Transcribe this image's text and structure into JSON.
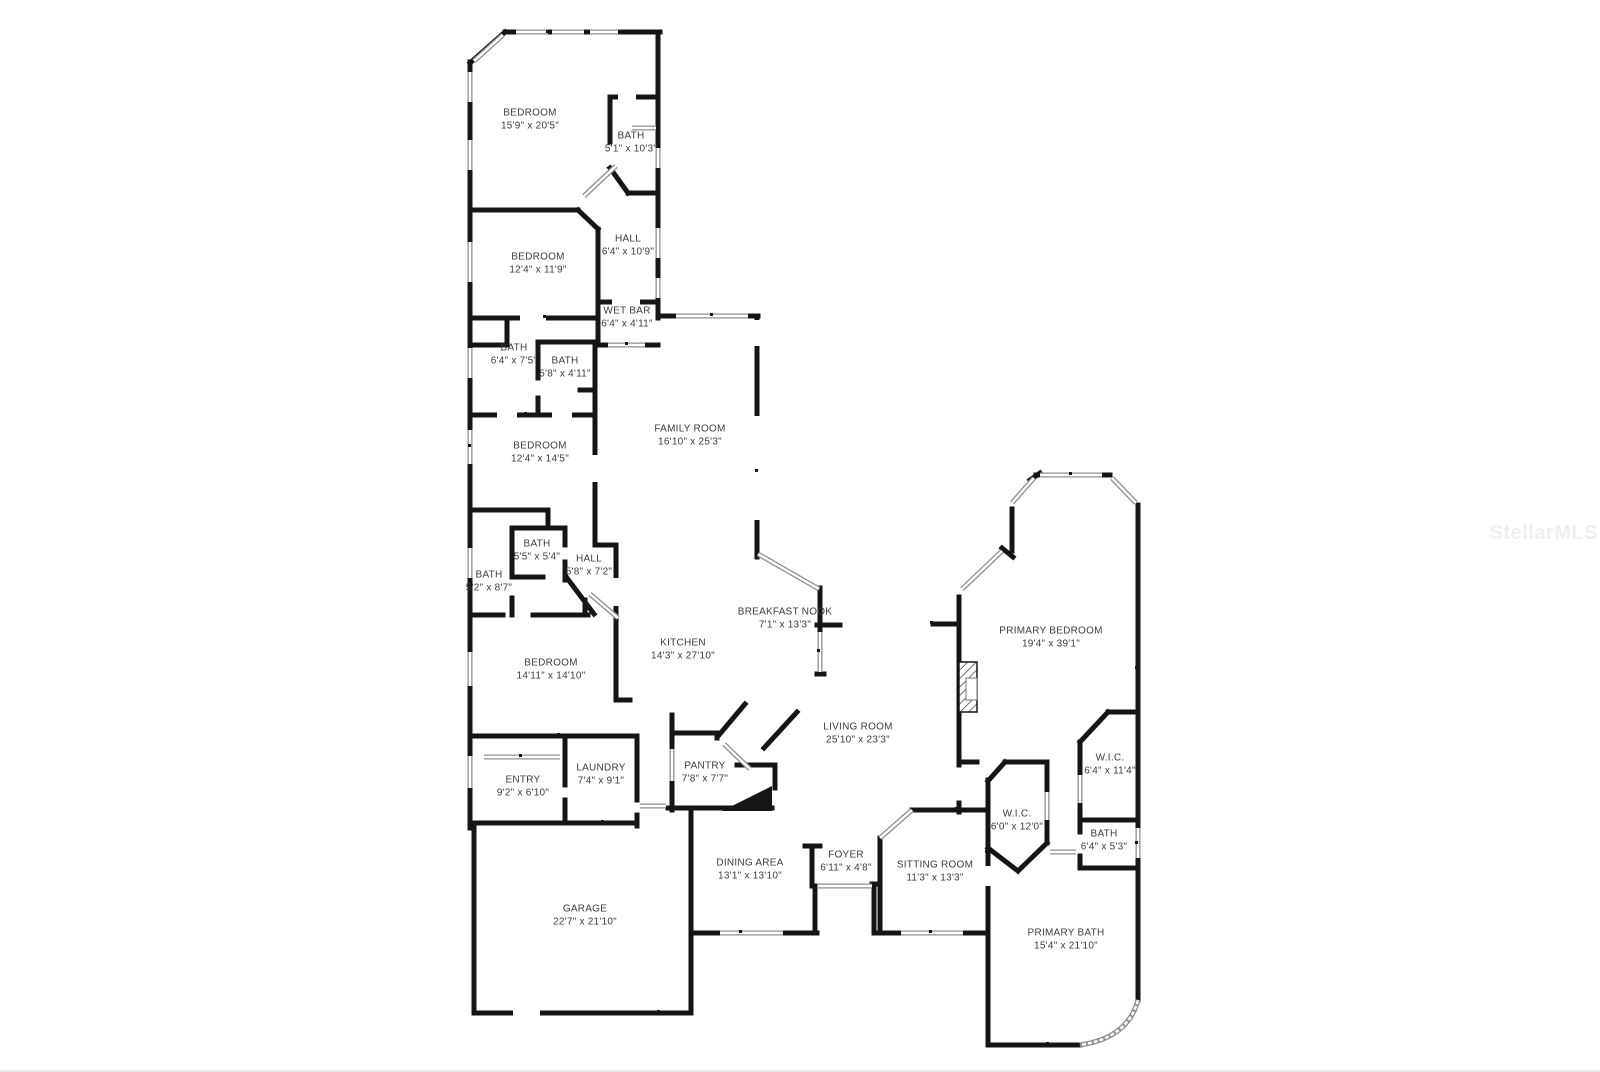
{
  "watermark": {
    "text": "StellarMLS"
  },
  "rooms": [
    {
      "name": "BEDROOM",
      "dims": "15'9\" x 20'5\""
    },
    {
      "name": "BATH",
      "dims": "5'1\" x 10'3\""
    },
    {
      "name": "BEDROOM",
      "dims": "12'4\" x 11'9\""
    },
    {
      "name": "HALL",
      "dims": "6'4\" x 10'9\""
    },
    {
      "name": "WET BAR",
      "dims": "6'4\" x 4'11\""
    },
    {
      "name": "BATH",
      "dims": "6'4\" x 7'5\""
    },
    {
      "name": "BATH",
      "dims": "5'8\" x 4'11\""
    },
    {
      "name": "FAMILY ROOM",
      "dims": "16'10\" x 25'3\""
    },
    {
      "name": "BEDROOM",
      "dims": "12'4\" x 14'5\""
    },
    {
      "name": "BATH",
      "dims": "5'5\" x 5'4\""
    },
    {
      "name": "HALL",
      "dims": "5'8\" x 7'2\""
    },
    {
      "name": "BATH",
      "dims": "5'2\" x 8'7\""
    },
    {
      "name": "BREAKFAST NOOK",
      "dims": "7'1\" x 13'3\""
    },
    {
      "name": "KITCHEN",
      "dims": "14'3\" x 27'10\""
    },
    {
      "name": "PRIMARY BEDROOM",
      "dims": "19'4\" x 39'1\""
    },
    {
      "name": "BEDROOM",
      "dims": "14'11\" x 14'10\""
    },
    {
      "name": "LIVING ROOM",
      "dims": "25'10\" x 23'3\""
    },
    {
      "name": "PANTRY",
      "dims": "7'8\" x 7'7\""
    },
    {
      "name": "W.I.C.",
      "dims": "6'4\" x 11'4\""
    },
    {
      "name": "ENTRY",
      "dims": "9'2\" x 6'10\""
    },
    {
      "name": "LAUNDRY",
      "dims": "7'4\" x 9'1\""
    },
    {
      "name": "W.I.C.",
      "dims": "6'0\" x 12'0\""
    },
    {
      "name": "BATH",
      "dims": "6'4\" x 5'3\""
    },
    {
      "name": "FOYER",
      "dims": "6'11\" x 4'8\""
    },
    {
      "name": "SITTING ROOM",
      "dims": "11'3\" x 13'3\""
    },
    {
      "name": "DINING AREA",
      "dims": "13'1\" x 13'10\""
    },
    {
      "name": "GARAGE",
      "dims": "22'7\" x 21'10\""
    },
    {
      "name": "PRIMARY BATH",
      "dims": "15'4\" x 21'10\""
    }
  ]
}
